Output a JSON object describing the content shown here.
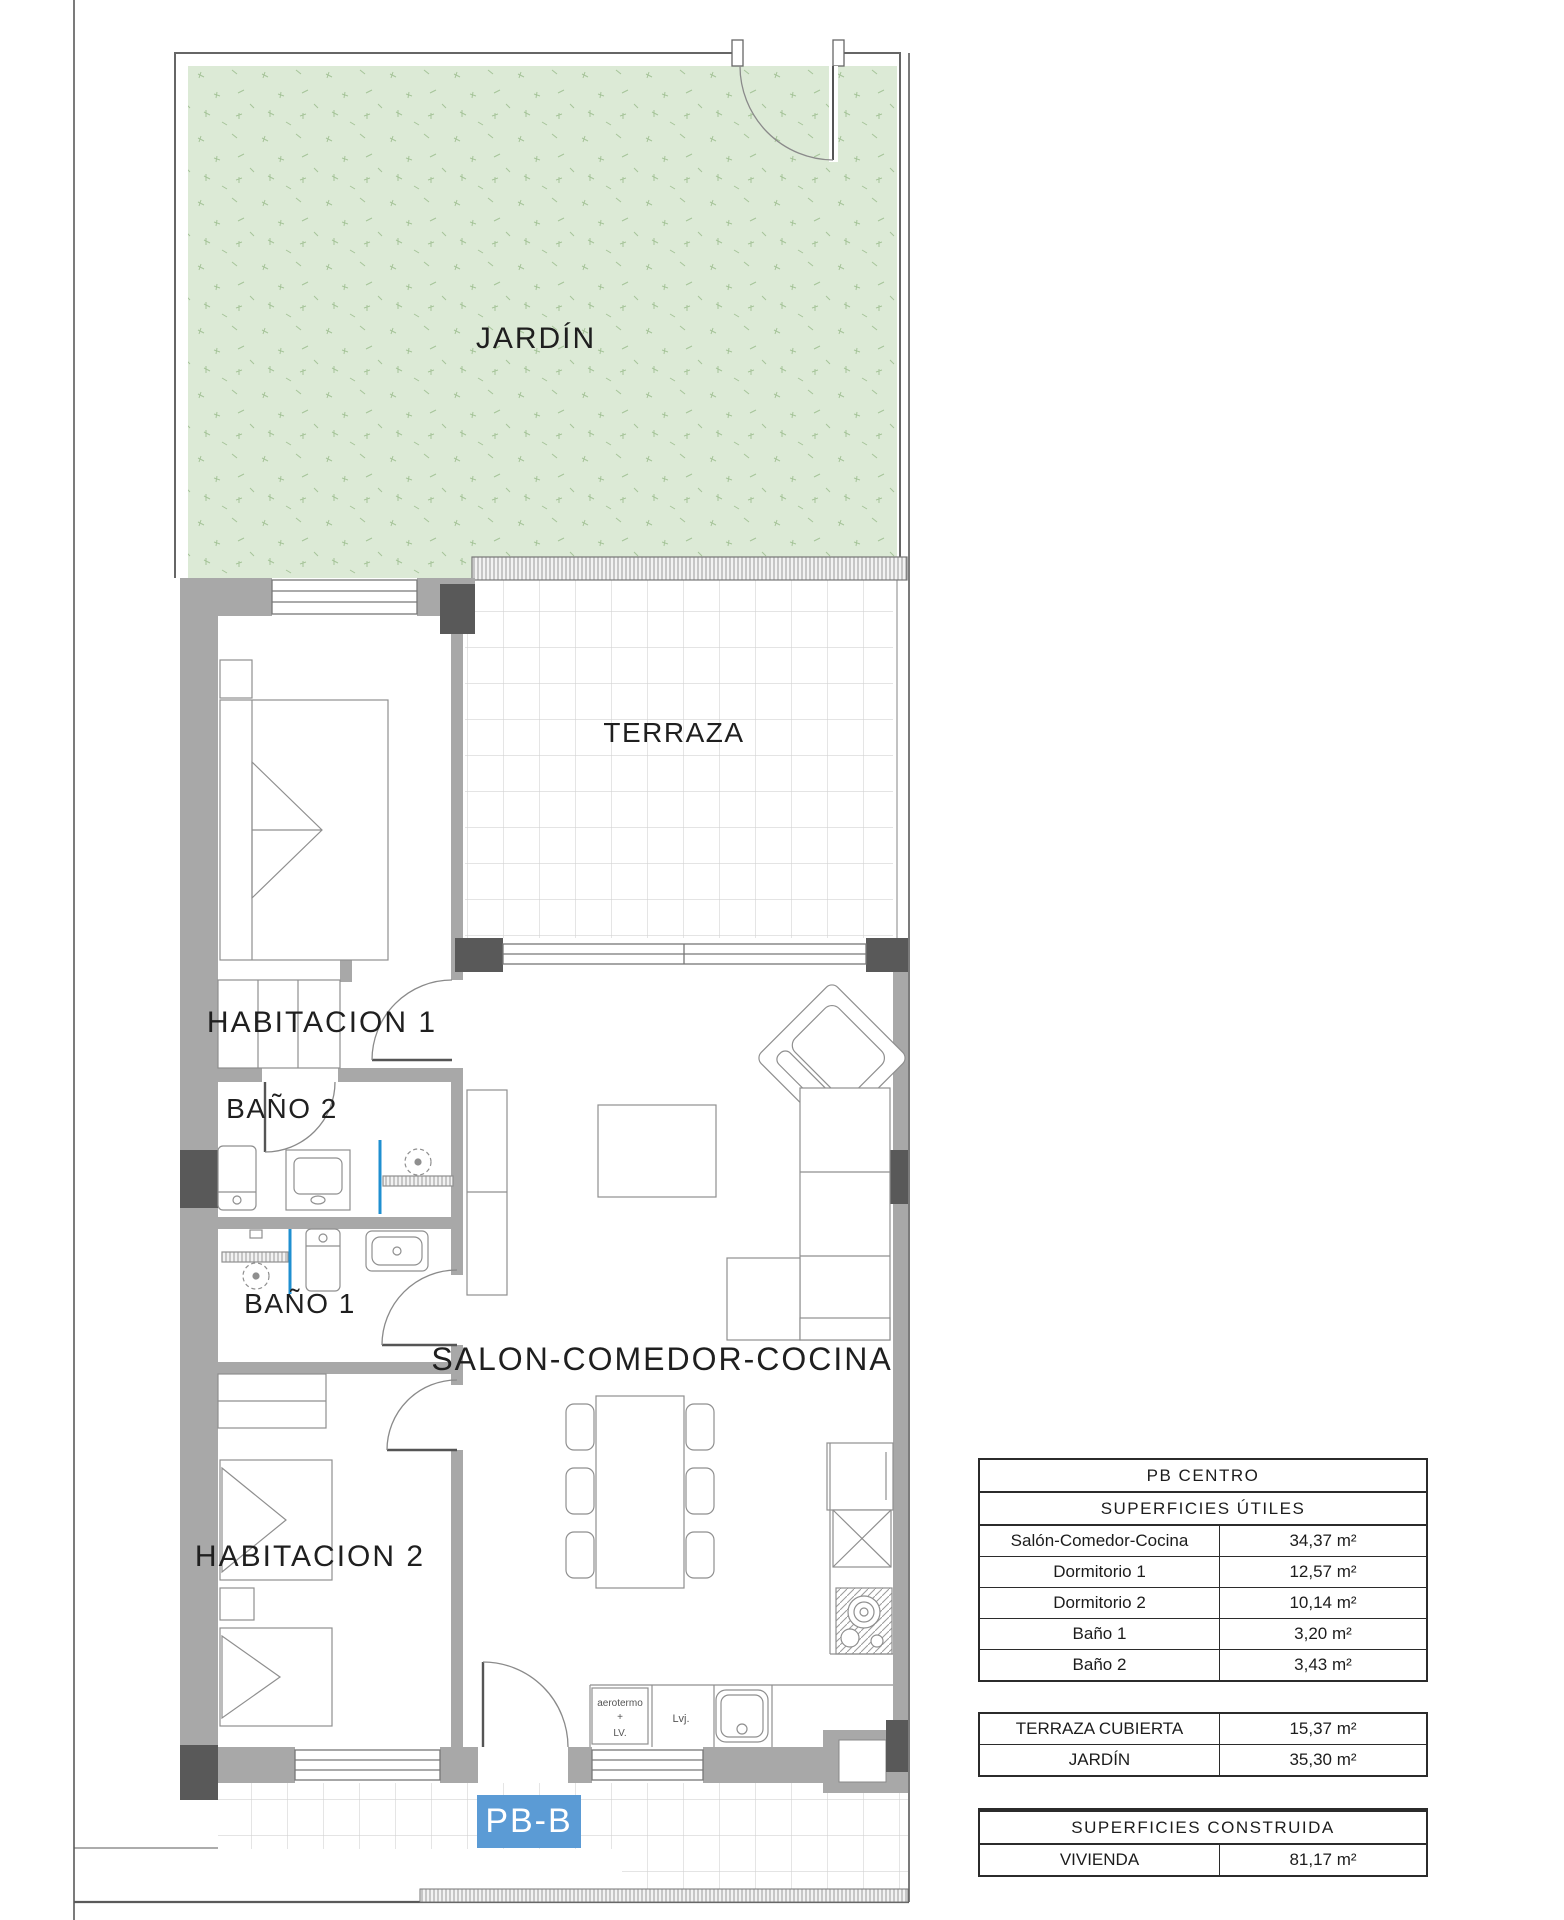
{
  "plan": {
    "rooms": {
      "garden": "JARDÍN",
      "terrace": "TERRAZA",
      "bedroom1": "HABITACION 1",
      "bedroom2": "HABITACION 2",
      "bath1": "BAÑO 1",
      "bath2": "BAÑO 2",
      "living": "SALON-COMEDOR-COCINA"
    },
    "kitchen": {
      "aerotermo_line1": "aerotermo",
      "aerotermo_line2": "+",
      "aerotermo_line3": "LV.",
      "dishwasher": "Lvj."
    },
    "unit_label": "PB-B",
    "colors": {
      "garden_green": "#dcead6",
      "wall_gray": "#a8a8a8",
      "pillar_dark": "#595959",
      "badge_blue": "#5b9bd5",
      "fixture_blue": "#1f8fd0"
    }
  },
  "tables": {
    "utiles": {
      "title": "PB CENTRO",
      "subtitle": "SUPERFICIES ÚTILES",
      "rows": [
        {
          "label": "Salón-Comedor-Cocina",
          "value": "34,37 m²"
        },
        {
          "label": "Dormitorio 1",
          "value": "12,57 m²"
        },
        {
          "label": "Dormitorio 2",
          "value": "10,14 m²"
        },
        {
          "label": "Baño 1",
          "value": "3,20 m²"
        },
        {
          "label": "Baño 2",
          "value": "3,43 m²"
        }
      ]
    },
    "exterior": {
      "rows": [
        {
          "label": "TERRAZA CUBIERTA",
          "value": "15,37 m²"
        },
        {
          "label": "JARDÍN",
          "value": "35,30 m²"
        }
      ]
    },
    "construida": {
      "title": "SUPERFICIES CONSTRUIDA",
      "rows": [
        {
          "label": "VIVIENDA",
          "value": "81,17 m²"
        }
      ]
    }
  }
}
